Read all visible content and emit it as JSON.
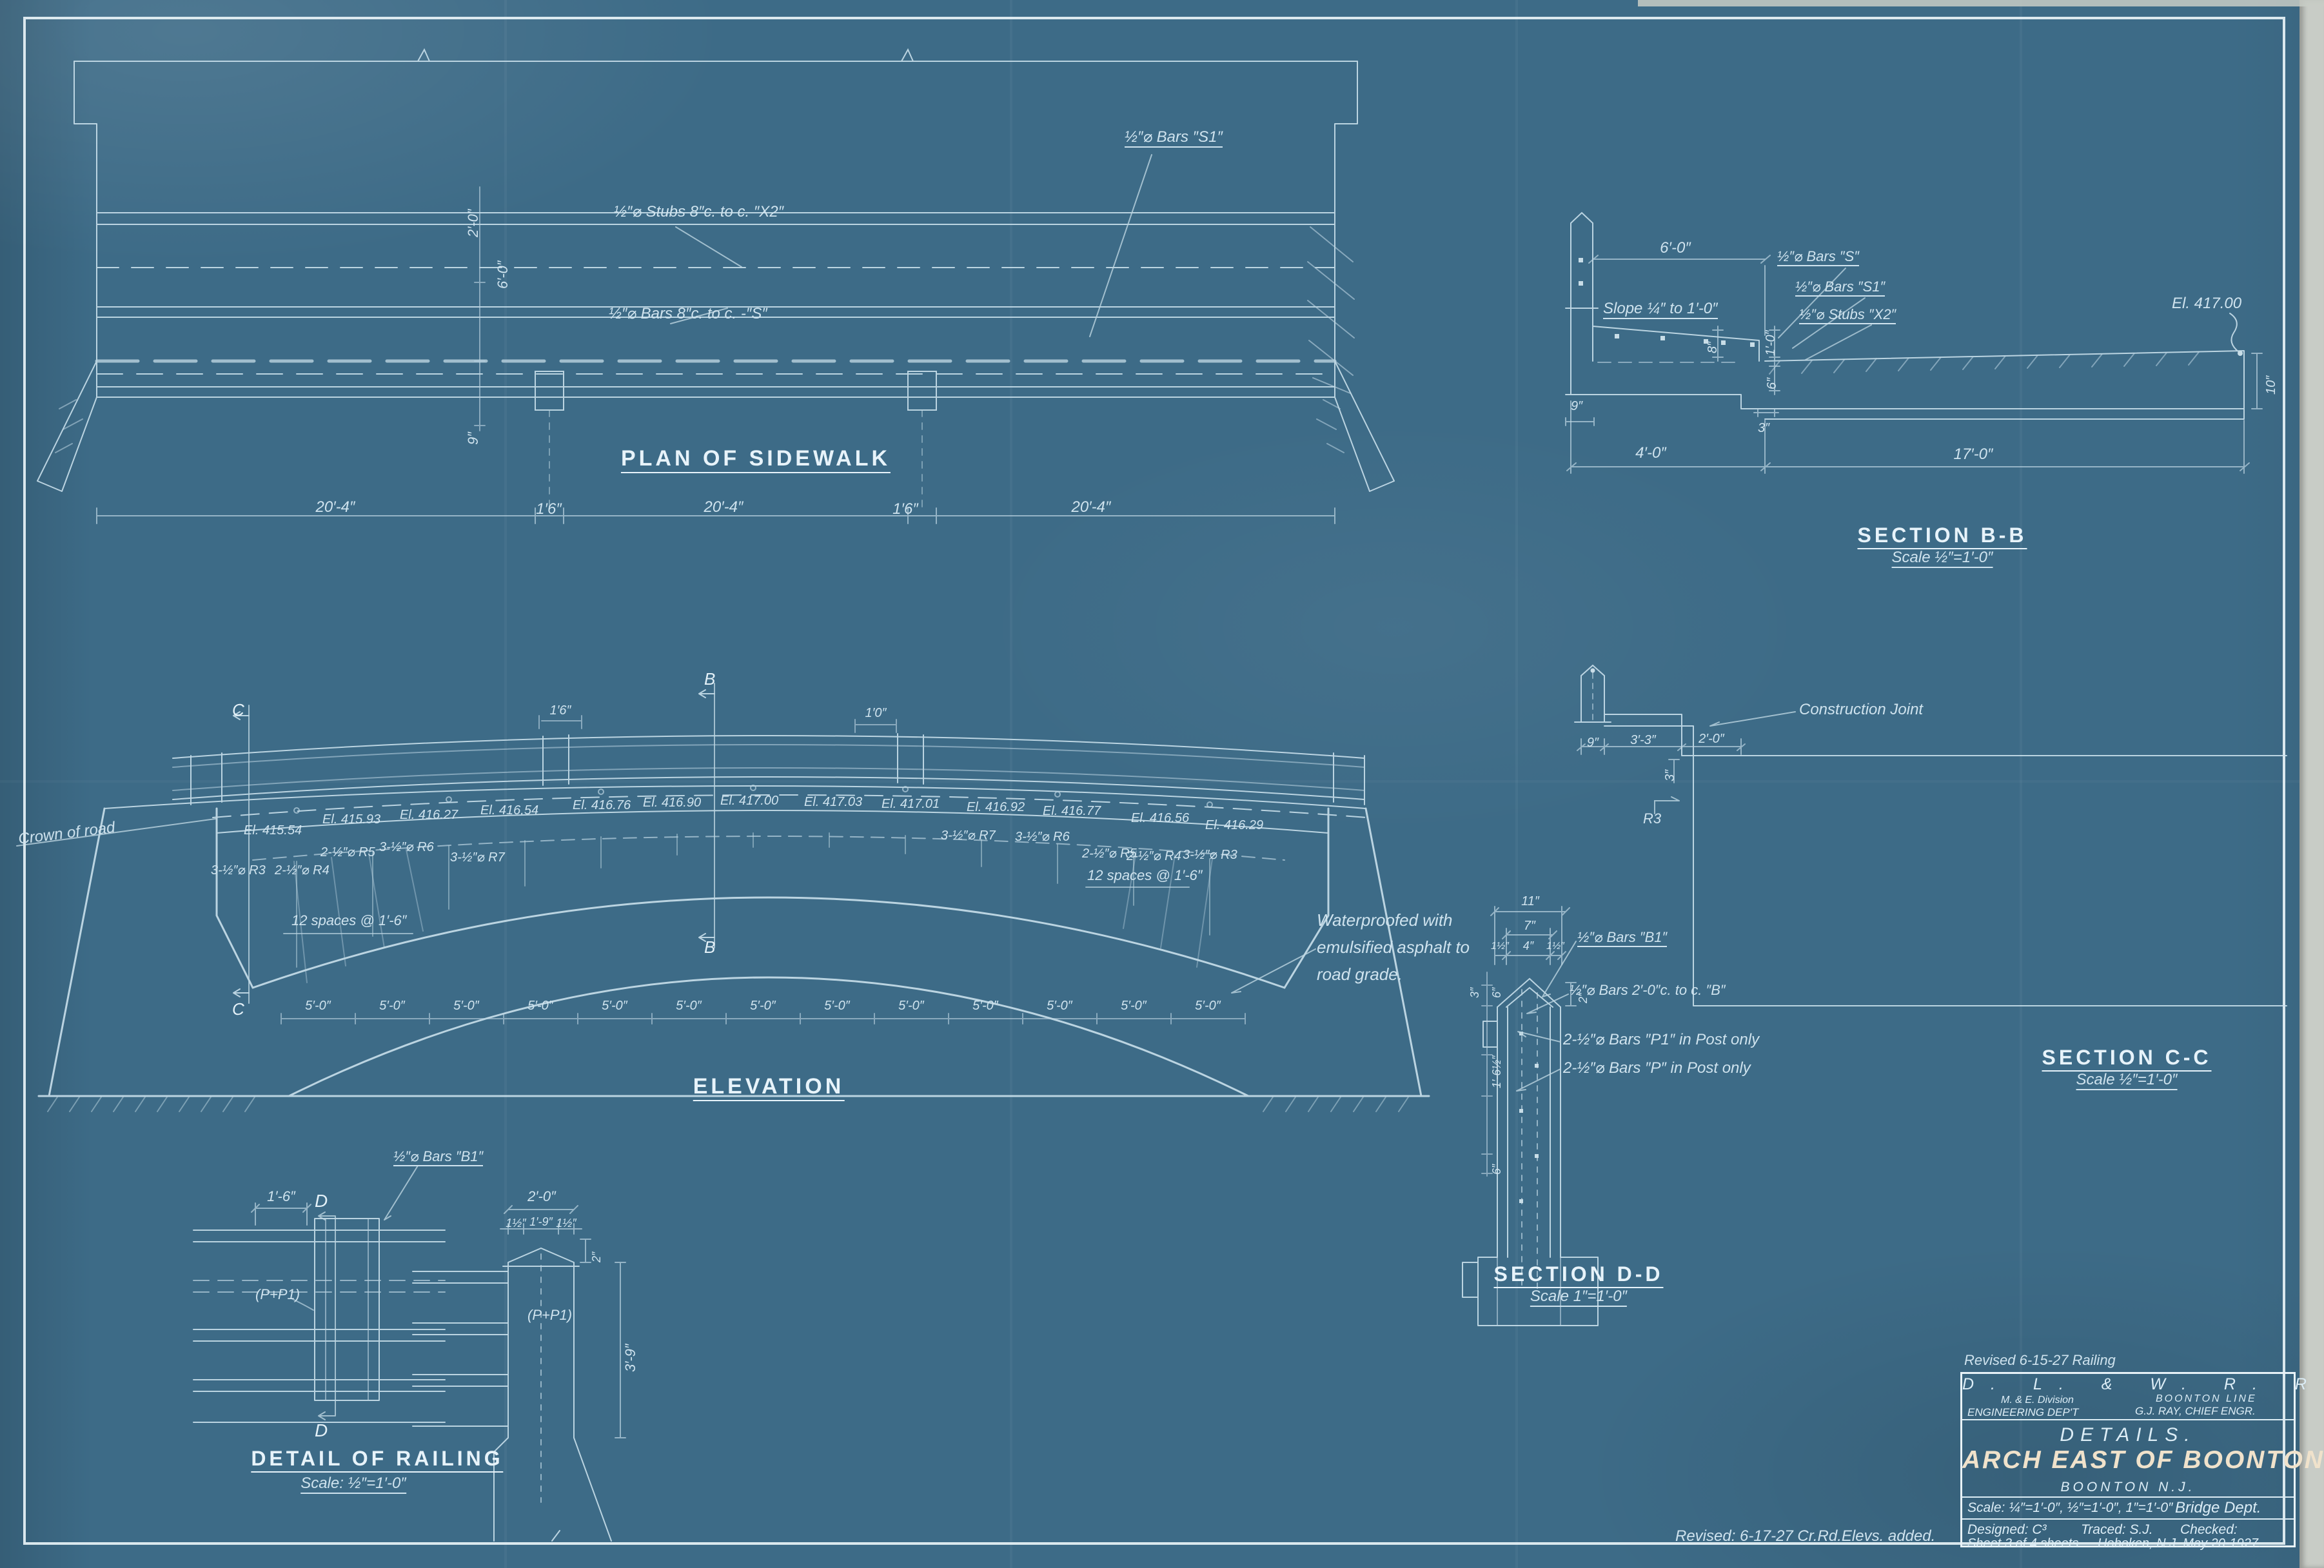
{
  "sheet": {
    "revision_note_top": "Revised 6-15-27 Railing",
    "revision_note_bottom": "Revised: 6-17-27   Cr.Rd.Elevs. added.",
    "colors": {
      "paper": "#3d6b87",
      "line": "#cfe3ee",
      "title_accent": "#f0e2cb"
    }
  },
  "plan": {
    "title": "PLAN OF SIDEWALK",
    "label_stubs": "½″⌀ Stubs 8″c. to c. ″X2″",
    "label_bars_s": "½″⌀ Bars 8″c. to c. -″S″",
    "label_bars_s1": "½″⌀ Bars ″S1″",
    "dims_bottom": [
      "20′-4″",
      "1′6″",
      "20′-4″",
      "1′6″",
      "20′-4″"
    ],
    "dims_left": [
      "2′-0″",
      "6′-0″",
      "9″"
    ]
  },
  "section_bb": {
    "title": "SECTION B-B",
    "scale": "Scale ½″=1′-0″",
    "dim_top": "6′-0″",
    "label_slope": "Slope ¼″ to 1′-0″",
    "label_bars_s": "½″⌀ Bars ″S″",
    "label_bars_s1": "½″⌀ Bars ″S1″",
    "label_stubs": "½″⌀ Stubs ″X2″",
    "elevation_mark": "El. 417.00",
    "dims": {
      "d10": "10″",
      "d9": "9″",
      "d8": "8″",
      "d1_0": "1′-0″",
      "d6": "6″",
      "d3": "3″",
      "d4_0": "4′-0″",
      "d17_0": "17′-0″"
    }
  },
  "elevation": {
    "title": "ELEVATION",
    "crown_label": "Crown of road",
    "elevations": [
      "El. 415.54",
      "El. 415.93",
      "El. 416.27",
      "El. 416.54",
      "El. 416.76",
      "El. 416.90",
      "El. 417.00",
      "El. 417.03",
      "El. 417.01",
      "El. 416.92",
      "El. 416.77",
      "El. 416.56",
      "El. 416.29"
    ],
    "bars_left": [
      "3-½″⌀ R3",
      "2-½″⌀ R4",
      "2-½″⌀ R5",
      "3-½″⌀ R6",
      "3-½″⌀ R7"
    ],
    "bars_right": [
      "3-½″⌀ R7",
      "3-½″⌀ R6",
      "2-½″⌀ R5",
      "2-½″⌀ R4",
      "3-½″⌀ R3"
    ],
    "spaces_note": "12 spaces @ 1′-6″",
    "waterproof_note": [
      "Waterproofed with",
      "emulsified asphalt to",
      "road grade."
    ],
    "bottom_dims": [
      "5′-0″",
      "5′-0″",
      "5′-0″",
      "5′-0″",
      "5′-0″",
      "5′-0″",
      "5′-0″",
      "5′-0″",
      "5′-0″",
      "5′-0″",
      "5′-0″",
      "5′-0″",
      "5′-0″"
    ],
    "top_dims": [
      "1′6″",
      "1′0″"
    ],
    "section_markers": {
      "b": "B",
      "c": "C"
    }
  },
  "section_cc": {
    "title": "SECTION C-C",
    "scale": "Scale ½″=1′-0″",
    "label_joint": "Construction Joint",
    "dims": {
      "d9": "9″",
      "d3_3": "3′-3″",
      "d2_0": "2′-0″",
      "d3": "3″"
    },
    "bar_mark": "R3"
  },
  "section_dd": {
    "title": "SECTION D-D",
    "scale": "Scale 1″=1′-0″",
    "dims": {
      "d11": "11″",
      "d7": "7″",
      "d1h_l": "1½″",
      "d4": "4″",
      "d1h_r": "1½″",
      "d2": "2″",
      "d3": "3″",
      "d6_top": "6″",
      "d1_6h": "1′-6½″",
      "d6_bot": "6″"
    },
    "label_bars_b1": "½″⌀ Bars ″B1″",
    "label_bars_b": "½″⌀ Bars 2′-0″c. to c. ″B″",
    "label_bars_p1": "2-½″⌀ Bars ″P1″ in Post only",
    "label_bars_p": "2-½″⌀ Bars ″P″ in Post only"
  },
  "railing_detail": {
    "title": "DETAIL OF RAILING",
    "scale": "Scale: ½″=1′-0″",
    "label_bars_b1": "½″⌀ Bars ″B1″",
    "marker_d": "D",
    "left": {
      "dim_top": "1′-6″",
      "bars": "(P+P1)"
    },
    "right": {
      "dim_top": "2′-0″",
      "sub_dims": [
        "1½″",
        "1′-9″",
        "1½″"
      ],
      "dim_2": "2″",
      "bars": "(P+P1)",
      "dim_height": "3′-9″"
    }
  },
  "title_block": {
    "railroad": "D. L. & W. R. R.",
    "division": "M. & E. Division",
    "department": "ENGINEERING DEP'T",
    "line": "BOONTON LINE",
    "chief": "G.J. RAY, CHIEF ENGR.",
    "subtitle": "DETAILS.",
    "main_title": "ARCH EAST OF BOONTON.",
    "location": "BOONTON N.J.",
    "scales": "Scale: ¼″=1′-0″, ½″=1′-0″, 1″=1′-0″",
    "dept": "Bridge Dept.",
    "designed": "Designed: C³",
    "traced": "Traced: S.J.",
    "checked": "Checked:",
    "sheet_info": "Sheet 3 of 4 sheets",
    "place_date": "Hoboken, N.J. May 20-1927."
  }
}
